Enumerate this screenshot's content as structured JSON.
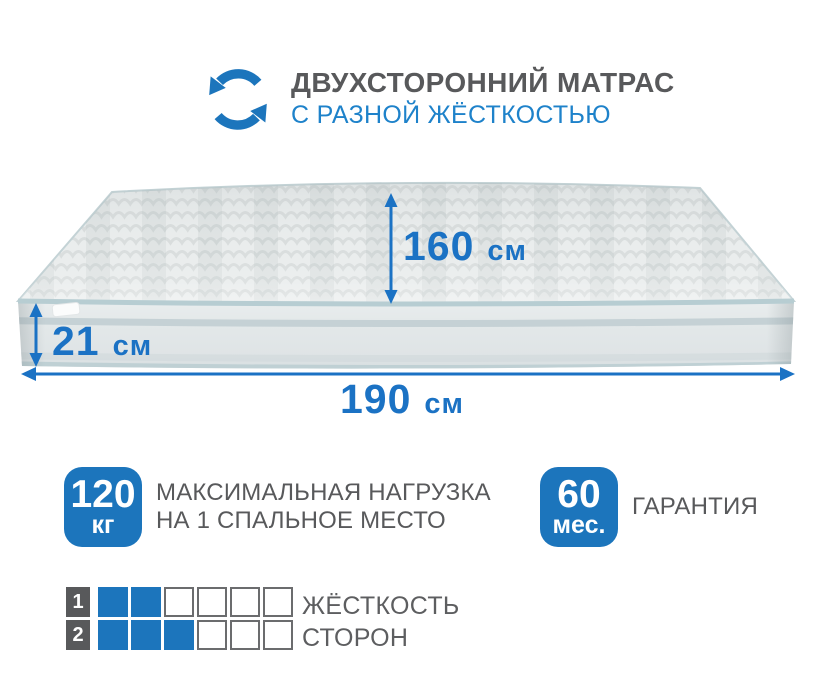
{
  "colors": {
    "accent_blue": "#1c75bc",
    "subtitle_blue": "#1e82ca",
    "dim_blue": "#1b72c4",
    "text_gray": "#58595b",
    "square_border": "#6b6c6e",
    "piping": "#b7cdd2",
    "mattress_light": "#ebeeee",
    "mattress_wave": "#d7dcdc",
    "band_stripe": "#c5d1d5"
  },
  "icons": {
    "header_icon": "rotation-arrows-icon"
  },
  "header": {
    "title": "ДВУХСТОРОННИЙ МАТРАС",
    "subtitle": "С РАЗНОЙ ЖЁСТКОСТЬЮ"
  },
  "dimensions": {
    "depth": {
      "value": "160",
      "unit": "см"
    },
    "height": {
      "value": "21",
      "unit": "см"
    },
    "width": {
      "value": "190",
      "unit": "см"
    }
  },
  "features": [
    {
      "badge_value": "120",
      "badge_unit": "кг",
      "label_line1": "МАКСИМАЛЬНАЯ НАГРУЗКА",
      "label_line2": "НА 1 СПАЛЬНОЕ МЕСТО"
    },
    {
      "badge_value": "60",
      "badge_unit": "мес.",
      "label_line1": "ГАРАНТИЯ",
      "label_line2": ""
    }
  ],
  "hardness": {
    "label_line1": "ЖЁСТКОСТЬ",
    "label_line2": "СТОРОН",
    "rows": [
      {
        "label": "1",
        "filled": 2,
        "total": 6
      },
      {
        "label": "2",
        "filled": 3,
        "total": 6
      }
    ]
  }
}
